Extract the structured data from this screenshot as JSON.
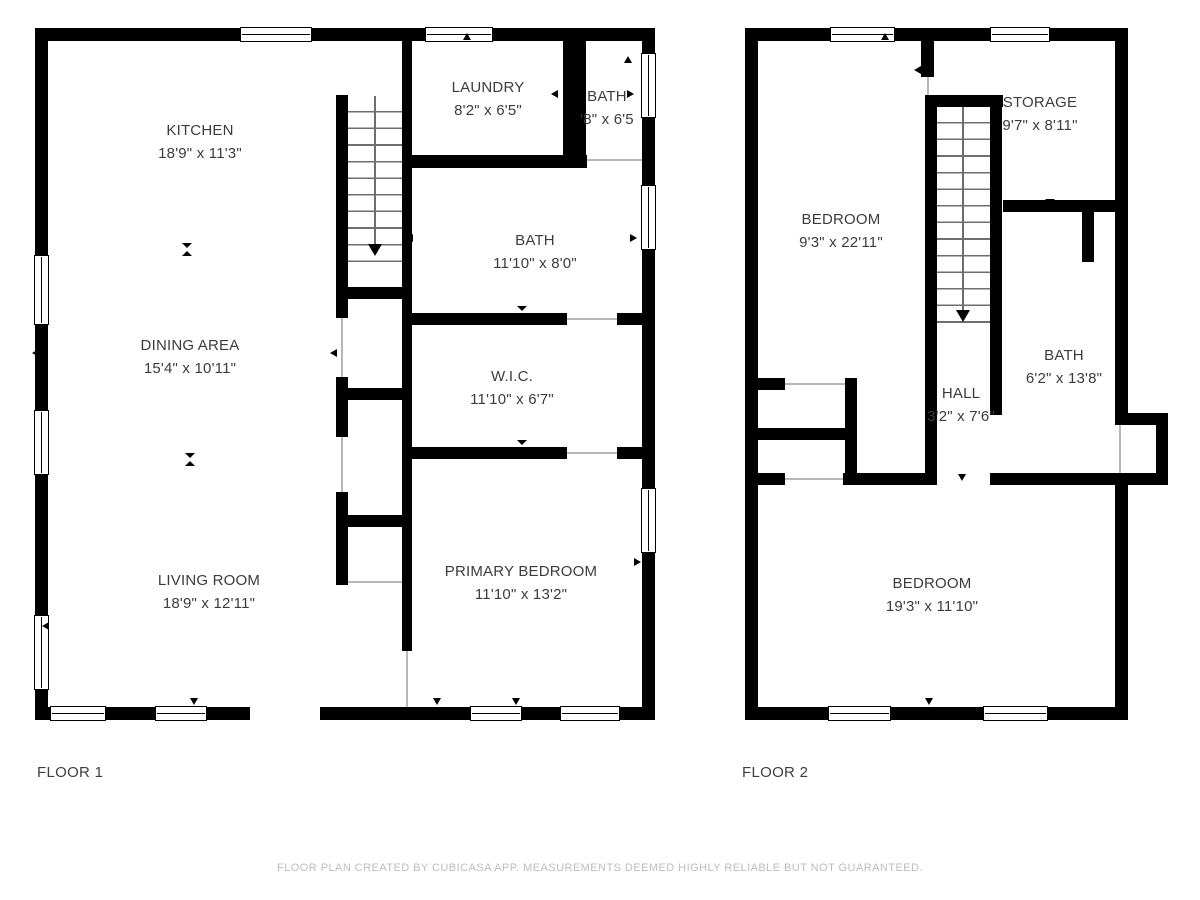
{
  "colors": {
    "wall": "#000000",
    "room_text": "#3c3c3c",
    "footer_text": "#bdbdbd",
    "background": "#ffffff",
    "stair_tread": "#6e6e6e"
  },
  "icons": {
    "door-marker-icon": "small solid black triangle (CSS border shape)",
    "opening-marker-icon": "hourglass made of two facing triangles",
    "stair-direction-icon": "thin line ending in downward arrowhead",
    "window-icon": "white double-pane rectangle with black outline"
  },
  "floors": [
    {
      "label": "FLOOR 1",
      "rooms": [
        {
          "name": "KITCHEN",
          "dims": "18'9\" x 11'3\""
        },
        {
          "name": "DINING AREA",
          "dims": "15'4\" x 10'11\""
        },
        {
          "name": "LIVING ROOM",
          "dims": "18'9\" x 12'11\""
        },
        {
          "name": "LAUNDRY",
          "dims": "8'2\" x 6'5\""
        },
        {
          "name": "BATH",
          "dims": "'8\" x 6'5"
        },
        {
          "name": "BATH",
          "dims": "11'10\" x 8'0\""
        },
        {
          "name": "W.I.C.",
          "dims": "11'10\" x 6'7\""
        },
        {
          "name": "PRIMARY BEDROOM",
          "dims": "11'10\" x 13'2\""
        }
      ]
    },
    {
      "label": "FLOOR 2",
      "rooms": [
        {
          "name": "BEDROOM",
          "dims": "9'3\" x 22'11\""
        },
        {
          "name": "STORAGE",
          "dims": "9'7\" x 8'11\""
        },
        {
          "name": "BATH",
          "dims": "6'2\" x 13'8\""
        },
        {
          "name": "HALL",
          "dims": "3'2\" x 7'6\""
        },
        {
          "name": "BEDROOM",
          "dims": "19'3\" x 11'10\""
        }
      ]
    }
  ],
  "footer": {
    "disclaimer": "FLOOR PLAN CREATED BY CUBICASA APP. MEASUREMENTS DEEMED HIGHLY RELIABLE BUT NOT GUARANTEED."
  }
}
